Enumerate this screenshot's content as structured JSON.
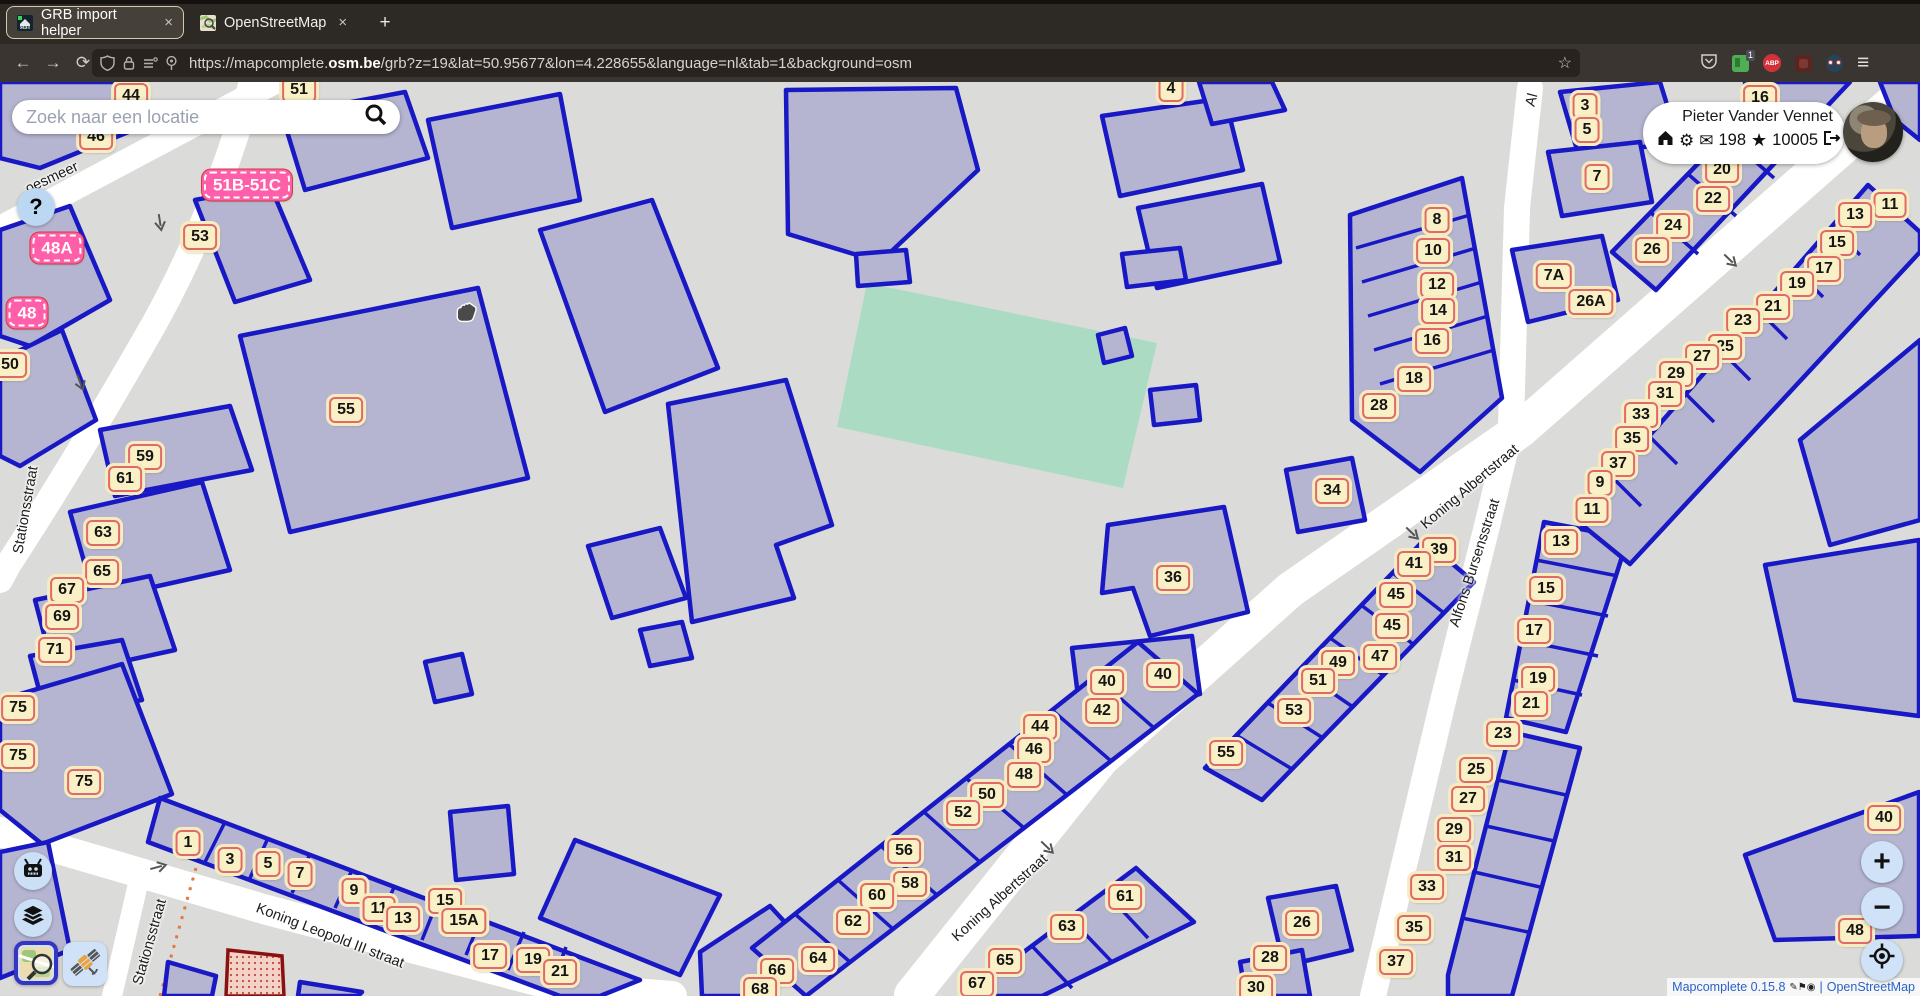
{
  "browser": {
    "tabs": [
      {
        "title": "GRB import helper"
      },
      {
        "title": "OpenStreetMap"
      }
    ],
    "url_prefix": "https://mapcomplete.",
    "url_domain": "osm.be",
    "url_path": "/grb?z=19&lat=50.95677&lon=4.228655&language=nl&tab=1&background=osm",
    "ext_badge": "1",
    "abp_label": "ABP"
  },
  "icons": {
    "back": "←",
    "forward": "→",
    "reload": "⟳",
    "menu": "≡",
    "bookmark_star": "☆",
    "close": "×",
    "new_tab": "+",
    "gear": "⚙",
    "mail": "✉",
    "star": "★",
    "plus": "+",
    "minus": "−",
    "question": "?"
  },
  "search": {
    "placeholder": "Zoek naar een locatie"
  },
  "user": {
    "name": "Pieter Vander Vennet",
    "messages": "198",
    "score": "10005"
  },
  "attribution": {
    "app": "Mapcomplete 0.15.8",
    "sep": "|",
    "osm": "OpenStreetMap"
  },
  "colors": {
    "map_bg": "#dbdbd9",
    "building_fill": "#b5b5d1",
    "building_stroke": "#1818c4",
    "road": "#ffffff",
    "green_parcel": "#abdcc3",
    "label_bg": "#faf0c5",
    "label_border": "#e06a6a",
    "pink_label": "#ff5fa8",
    "control_bg": "#cfe2f7",
    "selected_border": "#3535c2",
    "railway": "#e87343"
  },
  "map": {
    "street_labels": [
      {
        "text": "oesmeer",
        "x": 52,
        "y": 178,
        "rot": -25
      },
      {
        "text": "Stationsstraat",
        "x": 26,
        "y": 510,
        "rot": -80
      },
      {
        "text": "Stationsstraat",
        "x": 150,
        "y": 942,
        "rot": -74
      },
      {
        "text": "Koning Leopold III straat",
        "x": 330,
        "y": 936,
        "rot": 21
      },
      {
        "text": "Koning Albertstraat",
        "x": 1000,
        "y": 898,
        "rot": -42
      },
      {
        "text": "Koning Albertstraat",
        "x": 1470,
        "y": 487,
        "rot": -40
      },
      {
        "text": "Alfons Bursensstraat",
        "x": 1475,
        "y": 563,
        "rot": -72
      },
      {
        "text": "Al",
        "x": 1532,
        "y": 100,
        "rot": -75
      }
    ],
    "pink_labels": [
      {
        "t": "51B-51C",
        "x": 247,
        "y": 185
      },
      {
        "t": "48A",
        "x": 57,
        "y": 248
      },
      {
        "t": "48",
        "x": 27,
        "y": 313
      }
    ],
    "house_numbers": [
      {
        "t": "44",
        "x": 131,
        "y": 96
      },
      {
        "t": "51",
        "x": 299,
        "y": 90
      },
      {
        "t": "4",
        "x": 1171,
        "y": 89
      },
      {
        "t": "46",
        "x": 96,
        "y": 137
      },
      {
        "t": "53",
        "x": 200,
        "y": 237
      },
      {
        "t": "50",
        "x": 10,
        "y": 365
      },
      {
        "t": "55",
        "x": 346,
        "y": 410
      },
      {
        "t": "59",
        "x": 145,
        "y": 457
      },
      {
        "t": "61",
        "x": 125,
        "y": 479
      },
      {
        "t": "63",
        "x": 103,
        "y": 533
      },
      {
        "t": "65",
        "x": 102,
        "y": 572
      },
      {
        "t": "67",
        "x": 67,
        "y": 590
      },
      {
        "t": "69",
        "x": 62,
        "y": 617
      },
      {
        "t": "71",
        "x": 55,
        "y": 650
      },
      {
        "t": "75",
        "x": 18,
        "y": 708
      },
      {
        "t": "75",
        "x": 18,
        "y": 756
      },
      {
        "t": "75",
        "x": 84,
        "y": 782
      },
      {
        "t": "1",
        "x": 188,
        "y": 843
      },
      {
        "t": "3",
        "x": 230,
        "y": 860
      },
      {
        "t": "5",
        "x": 268,
        "y": 864
      },
      {
        "t": "7",
        "x": 300,
        "y": 874
      },
      {
        "t": "9",
        "x": 354,
        "y": 891
      },
      {
        "t": "11",
        "x": 379,
        "y": 909
      },
      {
        "t": "13",
        "x": 403,
        "y": 919
      },
      {
        "t": "15",
        "x": 445,
        "y": 901
      },
      {
        "t": "15A",
        "x": 464,
        "y": 921
      },
      {
        "t": "17",
        "x": 490,
        "y": 956
      },
      {
        "t": "19",
        "x": 533,
        "y": 960
      },
      {
        "t": "21",
        "x": 560,
        "y": 972
      },
      {
        "t": "56",
        "x": 904,
        "y": 851
      },
      {
        "t": "58",
        "x": 910,
        "y": 884
      },
      {
        "t": "60",
        "x": 877,
        "y": 896
      },
      {
        "t": "62",
        "x": 853,
        "y": 922
      },
      {
        "t": "64",
        "x": 818,
        "y": 959
      },
      {
        "t": "66",
        "x": 777,
        "y": 971
      },
      {
        "t": "68",
        "x": 760,
        "y": 990
      },
      {
        "t": "61",
        "x": 1125,
        "y": 897
      },
      {
        "t": "63",
        "x": 1067,
        "y": 927
      },
      {
        "t": "65",
        "x": 1005,
        "y": 961
      },
      {
        "t": "67",
        "x": 977,
        "y": 984
      },
      {
        "t": "40",
        "x": 1107,
        "y": 682
      },
      {
        "t": "40",
        "x": 1163,
        "y": 675
      },
      {
        "t": "42",
        "x": 1102,
        "y": 711
      },
      {
        "t": "44",
        "x": 1040,
        "y": 727
      },
      {
        "t": "46",
        "x": 1034,
        "y": 750
      },
      {
        "t": "48",
        "x": 1024,
        "y": 775
      },
      {
        "t": "50",
        "x": 987,
        "y": 795
      },
      {
        "t": "52",
        "x": 963,
        "y": 813
      },
      {
        "t": "34",
        "x": 1332,
        "y": 491
      },
      {
        "t": "36",
        "x": 1173,
        "y": 578
      },
      {
        "t": "39",
        "x": 1439,
        "y": 550
      },
      {
        "t": "41",
        "x": 1414,
        "y": 564
      },
      {
        "t": "45",
        "x": 1396,
        "y": 595
      },
      {
        "t": "45",
        "x": 1392,
        "y": 626
      },
      {
        "t": "47",
        "x": 1380,
        "y": 657
      },
      {
        "t": "49",
        "x": 1338,
        "y": 663
      },
      {
        "t": "51",
        "x": 1318,
        "y": 681
      },
      {
        "t": "53",
        "x": 1294,
        "y": 711
      },
      {
        "t": "55",
        "x": 1226,
        "y": 753
      },
      {
        "t": "26",
        "x": 1302,
        "y": 923
      },
      {
        "t": "28",
        "x": 1270,
        "y": 958
      },
      {
        "t": "30",
        "x": 1256,
        "y": 988
      },
      {
        "t": "13",
        "x": 1561,
        "y": 542
      },
      {
        "t": "15",
        "x": 1546,
        "y": 589
      },
      {
        "t": "17",
        "x": 1534,
        "y": 631
      },
      {
        "t": "19",
        "x": 1538,
        "y": 679
      },
      {
        "t": "21",
        "x": 1531,
        "y": 704
      },
      {
        "t": "23",
        "x": 1503,
        "y": 734
      },
      {
        "t": "25",
        "x": 1476,
        "y": 770
      },
      {
        "t": "27",
        "x": 1468,
        "y": 799
      },
      {
        "t": "29",
        "x": 1454,
        "y": 830
      },
      {
        "t": "31",
        "x": 1454,
        "y": 858
      },
      {
        "t": "33",
        "x": 1427,
        "y": 887
      },
      {
        "t": "35",
        "x": 1414,
        "y": 928
      },
      {
        "t": "37",
        "x": 1396,
        "y": 962
      },
      {
        "t": "8",
        "x": 1437,
        "y": 220
      },
      {
        "t": "10",
        "x": 1433,
        "y": 251
      },
      {
        "t": "12",
        "x": 1437,
        "y": 285
      },
      {
        "t": "14",
        "x": 1438,
        "y": 311
      },
      {
        "t": "16",
        "x": 1432,
        "y": 341
      },
      {
        "t": "18",
        "x": 1414,
        "y": 379
      },
      {
        "t": "28",
        "x": 1379,
        "y": 406
      },
      {
        "t": "3",
        "x": 1585,
        "y": 106
      },
      {
        "t": "5",
        "x": 1587,
        "y": 130
      },
      {
        "t": "7",
        "x": 1597,
        "y": 177
      },
      {
        "t": "7A",
        "x": 1554,
        "y": 276
      },
      {
        "t": "26A",
        "x": 1591,
        "y": 302
      },
      {
        "t": "16",
        "x": 1760,
        "y": 98
      },
      {
        "t": "20",
        "x": 1722,
        "y": 170
      },
      {
        "t": "22",
        "x": 1713,
        "y": 199
      },
      {
        "t": "24",
        "x": 1673,
        "y": 226
      },
      {
        "t": "26",
        "x": 1652,
        "y": 250
      },
      {
        "t": "11",
        "x": 1890,
        "y": 205
      },
      {
        "t": "13",
        "x": 1855,
        "y": 215
      },
      {
        "t": "15",
        "x": 1837,
        "y": 243
      },
      {
        "t": "17",
        "x": 1824,
        "y": 269
      },
      {
        "t": "19",
        "x": 1797,
        "y": 284
      },
      {
        "t": "21",
        "x": 1773,
        "y": 307
      },
      {
        "t": "23",
        "x": 1743,
        "y": 321
      },
      {
        "t": "25",
        "x": 1725,
        "y": 347
      },
      {
        "t": "27",
        "x": 1702,
        "y": 357
      },
      {
        "t": "29",
        "x": 1676,
        "y": 374
      },
      {
        "t": "31",
        "x": 1665,
        "y": 394
      },
      {
        "t": "33",
        "x": 1641,
        "y": 415
      },
      {
        "t": "35",
        "x": 1632,
        "y": 439
      },
      {
        "t": "37",
        "x": 1618,
        "y": 464
      },
      {
        "t": "9",
        "x": 1600,
        "y": 483
      },
      {
        "t": "11",
        "x": 1592,
        "y": 510
      },
      {
        "t": "40",
        "x": 1884,
        "y": 818
      },
      {
        "t": "48",
        "x": 1855,
        "y": 931
      }
    ]
  }
}
